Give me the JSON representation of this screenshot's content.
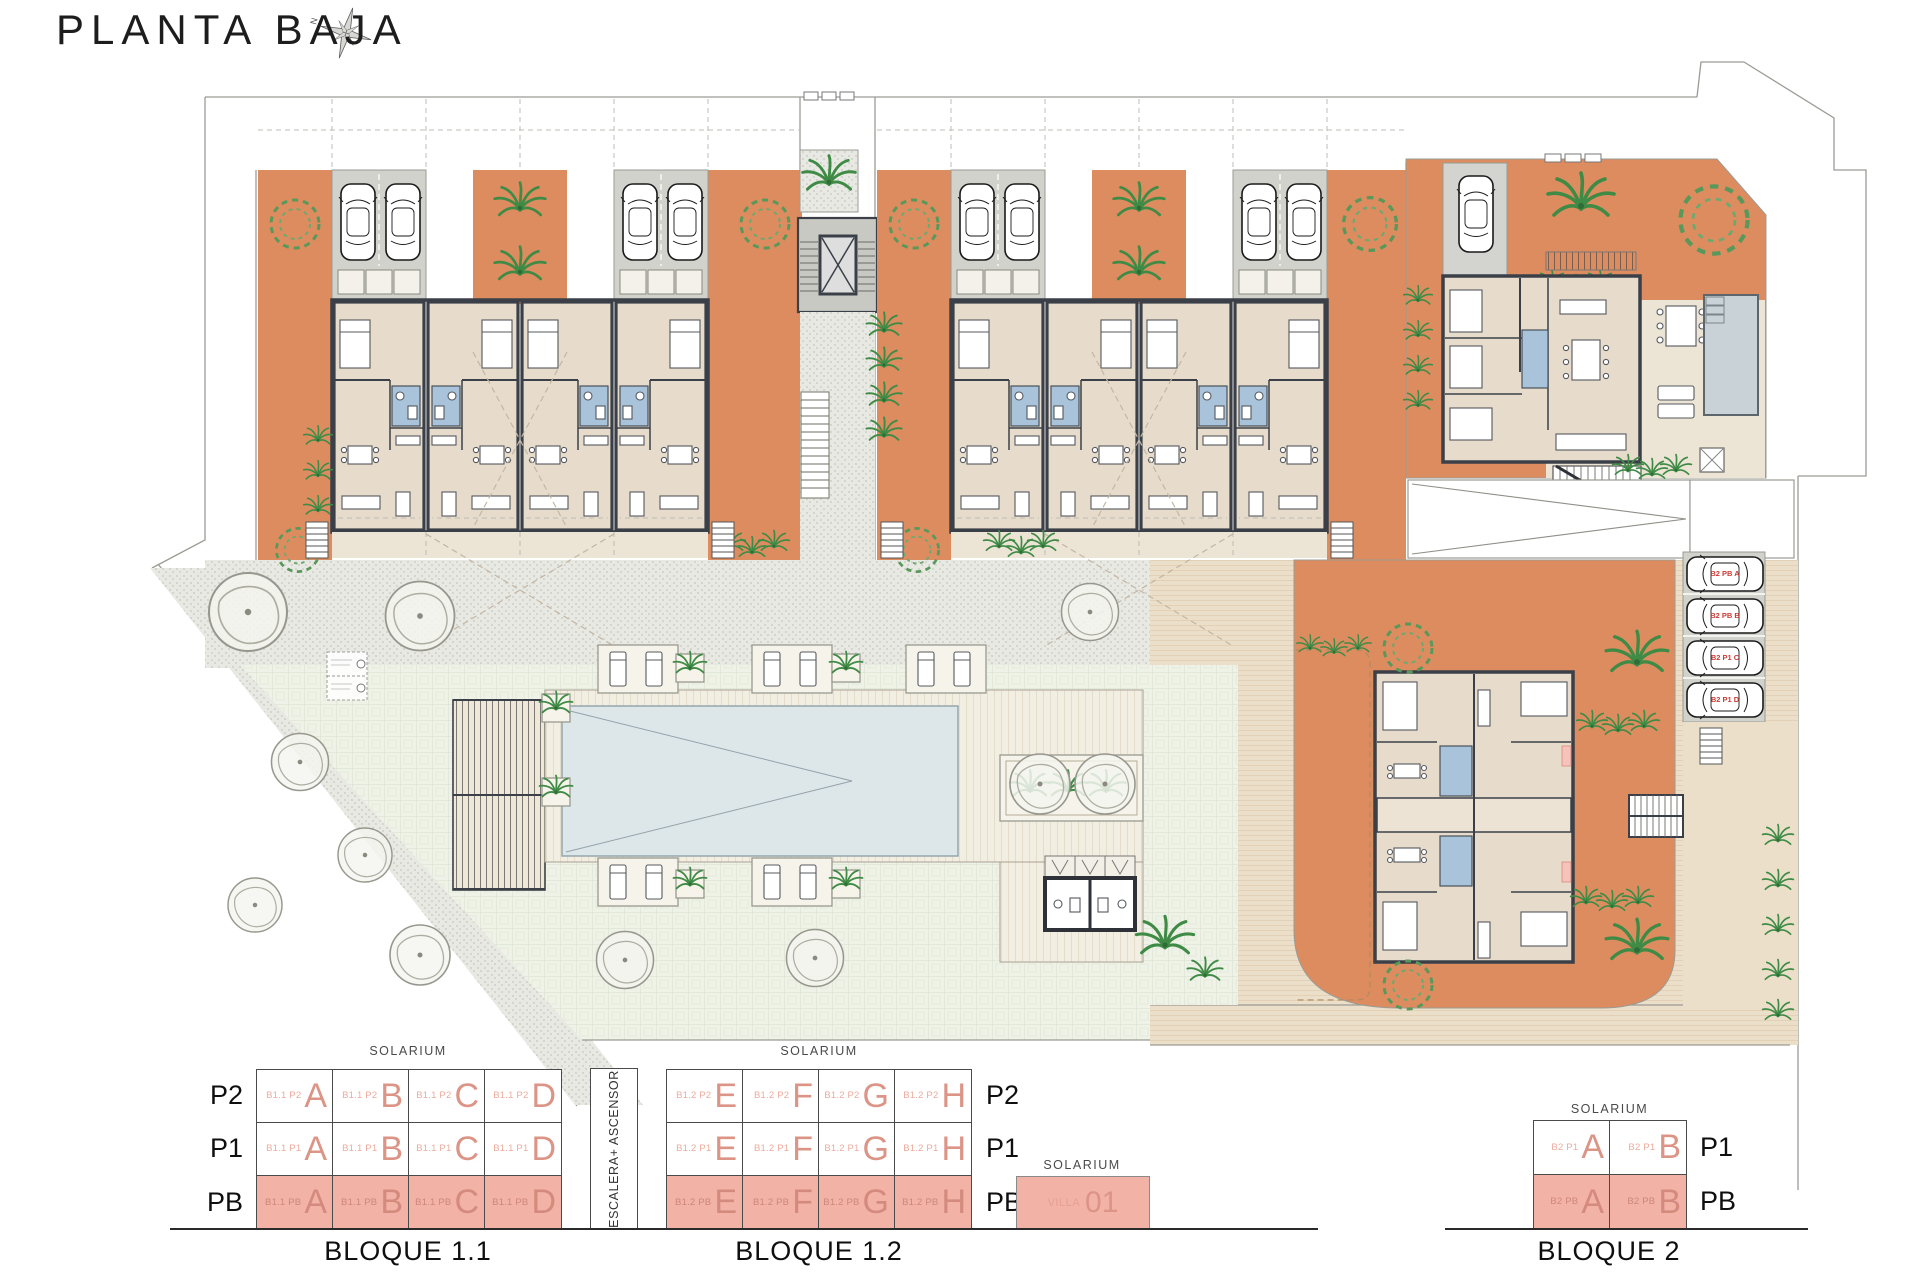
{
  "title": "PLANTA BAJA",
  "compass": {
    "north_label": "N"
  },
  "colors": {
    "terracotta": "#dd8c60",
    "floor_beige": "#e7dccb",
    "bath_blue": "#a9c4da",
    "parking_gray": "#d2d2cd",
    "pool_water": "#dde6e9",
    "lawn_green": "#eef2e7",
    "legend_pink_fill": "#f2b2a6",
    "legend_letter_color": "#dc9486",
    "parking_label_red": "#cc3b35",
    "wall_dark": "#3b4048"
  },
  "plan": {
    "parking_labels": [
      "B2 PB A",
      "B2 PB B",
      "B2 P1 C",
      "B2 P1 D"
    ]
  },
  "legend": {
    "solarium_label": "SOLARIUM",
    "escalera_label": "ESCALERA+ ASCENSOR",
    "bloque11": {
      "title": "BLOQUE 1.1",
      "floors": [
        {
          "label": "P2",
          "units": [
            {
              "prefix": "B1.1 P2",
              "letter": "A"
            },
            {
              "prefix": "B1.1 P2",
              "letter": "B"
            },
            {
              "prefix": "B1.1 P2",
              "letter": "C"
            },
            {
              "prefix": "B1.1 P2",
              "letter": "D"
            }
          ]
        },
        {
          "label": "P1",
          "units": [
            {
              "prefix": "B1.1 P1",
              "letter": "A"
            },
            {
              "prefix": "B1.1 P1",
              "letter": "B"
            },
            {
              "prefix": "B1.1 P1",
              "letter": "C"
            },
            {
              "prefix": "B1.1 P1",
              "letter": "D"
            }
          ]
        },
        {
          "label": "PB",
          "units": [
            {
              "prefix": "B1.1 PB",
              "letter": "A"
            },
            {
              "prefix": "B1.1 PB",
              "letter": "B"
            },
            {
              "prefix": "B1.1 PB",
              "letter": "C"
            },
            {
              "prefix": "B1.1 PB",
              "letter": "D"
            }
          ]
        }
      ]
    },
    "bloque12": {
      "title": "BLOQUE 1.2",
      "floors": [
        {
          "label": "P2",
          "units": [
            {
              "prefix": "B1.2 P2",
              "letter": "E"
            },
            {
              "prefix": "B1.2 P2",
              "letter": "F"
            },
            {
              "prefix": "B1.2 P2",
              "letter": "G"
            },
            {
              "prefix": "B1.2 P2",
              "letter": "H"
            }
          ]
        },
        {
          "label": "P1",
          "units": [
            {
              "prefix": "B1.2 P1",
              "letter": "E"
            },
            {
              "prefix": "B1.2 P1",
              "letter": "F"
            },
            {
              "prefix": "B1.2 P1",
              "letter": "G"
            },
            {
              "prefix": "B1.2 P1",
              "letter": "H"
            }
          ]
        },
        {
          "label": "PB",
          "units": [
            {
              "prefix": "B1.2 PB",
              "letter": "E"
            },
            {
              "prefix": "B1.2 PB",
              "letter": "F"
            },
            {
              "prefix": "B1.2 PB",
              "letter": "G"
            },
            {
              "prefix": "B1.2 PB",
              "letter": "H"
            }
          ]
        }
      ]
    },
    "villa": {
      "solarium": "SOLARIUM",
      "name": "VILLA",
      "number": "01"
    },
    "bloque2": {
      "title": "BLOQUE 2",
      "floors": [
        {
          "label": "P1",
          "units": [
            {
              "prefix": "B2 P1",
              "letter": "A"
            },
            {
              "prefix": "B2 P1",
              "letter": "B"
            }
          ]
        },
        {
          "label": "PB",
          "units": [
            {
              "prefix": "B2 PB",
              "letter": "A"
            },
            {
              "prefix": "B2 PB",
              "letter": "B"
            }
          ]
        }
      ]
    }
  }
}
